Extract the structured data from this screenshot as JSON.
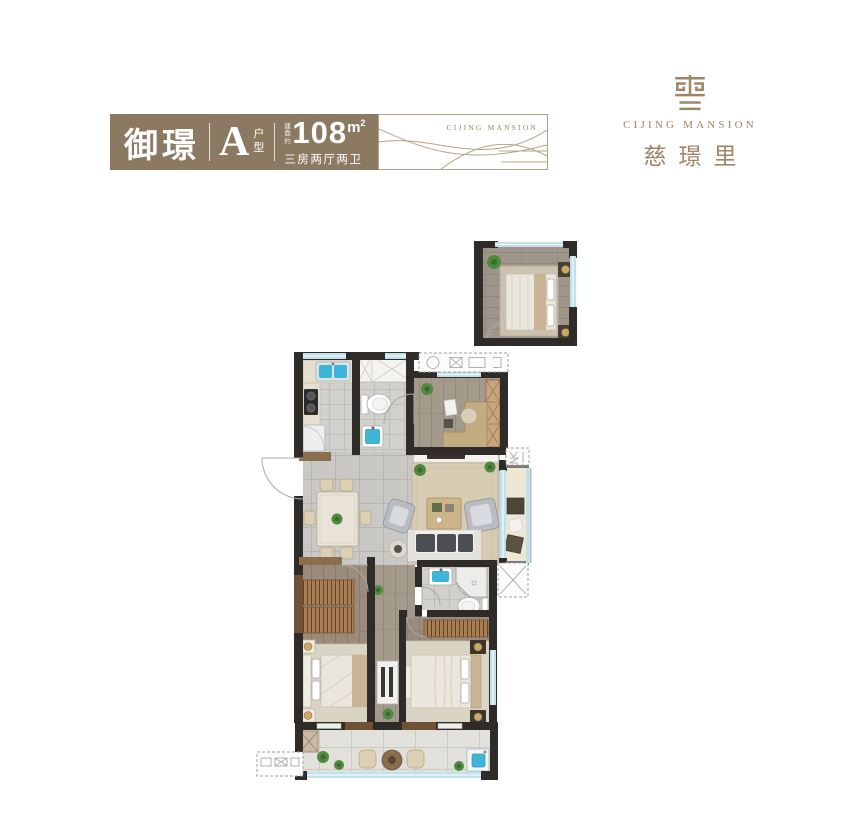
{
  "page": {
    "bg": "#ffffff"
  },
  "header": {
    "title": "御璟",
    "unit": {
      "letter": "A",
      "suffix": "户型"
    },
    "area": {
      "prefix": "建面约",
      "value": "108",
      "unit": "m",
      "unit_sup": "2",
      "desc": "三房两厅两卫"
    },
    "watermark": "CIJING MANSION"
  },
  "logo": {
    "en": "CIJING MANSION",
    "cn": "慈璟里"
  },
  "colors": {
    "page_bg": "#ffffff",
    "brand_brown": "#8b7961",
    "brand_gold": "#9d8668",
    "wave_line": "#b5a488",
    "panel_border": "#b3a286",
    "wall": "#2f2b28",
    "wall_brown": "#6e5137",
    "window": "#bfe1ec",
    "water": "#3eb4d8",
    "tile": "#c9c8c5",
    "tile_light": "#d1d0cd",
    "wood_light": "#a49a8c",
    "wood_dark": "#9a8b7d",
    "rug": "#d7cbb3",
    "rug_light": "#dad4c5",
    "counter": "#e6dfd0",
    "sofa": "#f1f0ed",
    "cushion": "#4b4f55",
    "gray_chair": "#b9bcc0",
    "wardrobe": "#aa7e51",
    "wardrobe_line": "#5d4426",
    "plant": "#4f8a3f",
    "plant_dark": "#3a6b2e",
    "lamp": "#c9a86a",
    "bed_white": "#eae6db",
    "bed_tan": "#c8b394",
    "balcony_floor": "#e1e0da",
    "platform": "#fcfcfb",
    "platform_line": "#9f9f9d",
    "table_wood": "#8a6f4e",
    "desk_tan": "#c3ab80"
  }
}
